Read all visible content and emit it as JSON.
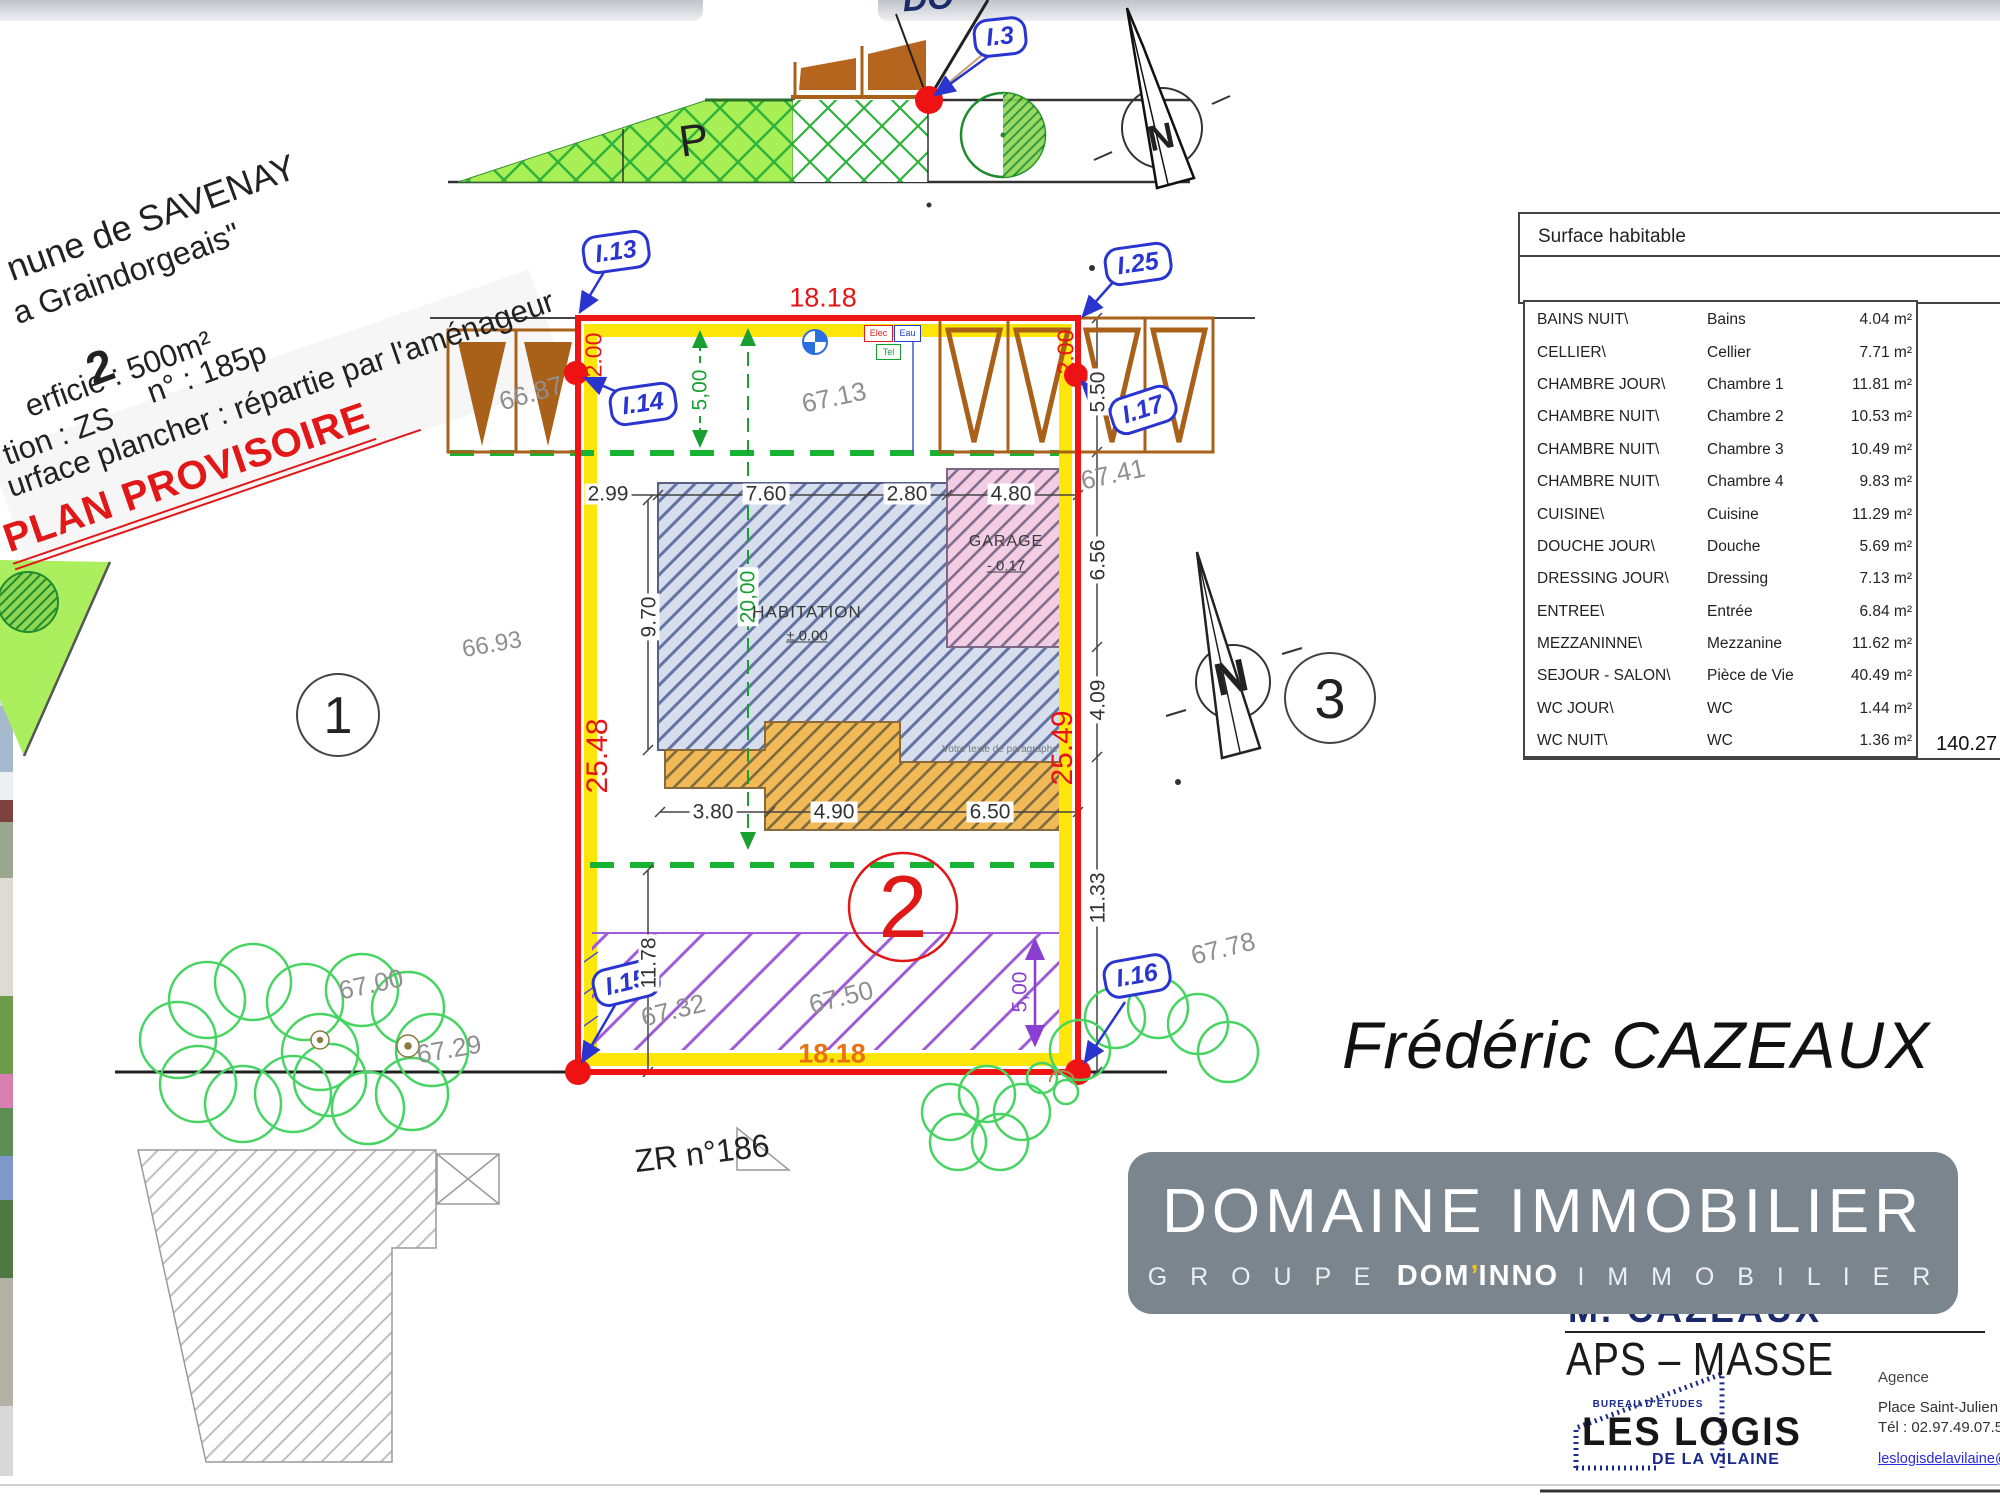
{
  "title_block": {
    "line1": "nune de SAVENAY",
    "line2": "a Graindorgeais\"",
    "lot_number": "2",
    "line3": "erficie : 500m²",
    "line3b": "n° :   185p",
    "line4": "tion : ZS",
    "line5": "urface plancher : répartie par l'aménageur",
    "stamp": "PLAN PROVISOIRE"
  },
  "top_partial_text": "DO",
  "surface_table": {
    "title": "Surface habitable",
    "total": "140.27",
    "rows": [
      {
        "code": "BAINS NUIT\\",
        "name": "Bains",
        "area": "4.04 m²"
      },
      {
        "code": "CELLIER\\",
        "name": "Cellier",
        "area": "7.71 m²"
      },
      {
        "code": "CHAMBRE JOUR\\",
        "name": "Chambre 1",
        "area": "11.81 m²"
      },
      {
        "code": "CHAMBRE NUIT\\",
        "name": "Chambre 2",
        "area": "10.53 m²"
      },
      {
        "code": "CHAMBRE NUIT\\",
        "name": "Chambre 3",
        "area": "10.49 m²"
      },
      {
        "code": "CHAMBRE NUIT\\",
        "name": "Chambre 4",
        "area": "9.83 m²"
      },
      {
        "code": "CUISINE\\",
        "name": "Cuisine",
        "area": "11.29 m²"
      },
      {
        "code": "DOUCHE JOUR\\",
        "name": "Douche",
        "area": "5.69 m²"
      },
      {
        "code": "DRESSING JOUR\\",
        "name": "Dressing",
        "area": "7.13 m²"
      },
      {
        "code": "ENTREE\\",
        "name": "Entrée",
        "area": "6.84 m²"
      },
      {
        "code": "MEZZANINNE\\",
        "name": "Mezzanine",
        "area": "11.62 m²"
      },
      {
        "code": "SEJOUR - SALON\\",
        "name": "Pièce de Vie",
        "area": "40.49 m²"
      },
      {
        "code": "WC JOUR\\",
        "name": "WC",
        "area": "1.44 m²"
      },
      {
        "code": "WC NUIT\\",
        "name": "WC",
        "area": "1.36 m²"
      }
    ]
  },
  "plan": {
    "labels": {
      "i3": "I.3",
      "i13": "I.13",
      "i14": "I.14",
      "i15": "I.15",
      "i16": "I.16",
      "i17": "I.17",
      "i25": "I.25"
    },
    "dims": {
      "top_width": "18.18",
      "bottom_width": "18.18",
      "left_height": "25.48",
      "right_height": "25.49",
      "left_offset": "2.00",
      "right_offset": "2.00",
      "green_front": "5,00",
      "green_depth": "20,00",
      "right_top": "5.50",
      "d299": "2.99",
      "d760": "7.60",
      "d280": "2.80",
      "d480": "4.80",
      "d970": "9.70",
      "d656": "6.56",
      "d409": "4.09",
      "d1133": "11.33",
      "d1178": "11.78",
      "d380": "3.80",
      "d490": "4.90",
      "d650": "6.50",
      "purple_back": "5,00"
    },
    "levels": {
      "l6687": "66.87",
      "l6713": "67.13",
      "l6741": "67.41",
      "l6693": "66.93",
      "l6700": "67.00",
      "l6729": "67.29",
      "l6732": "67.32",
      "l6750": "67.50",
      "l6778": "67.78"
    },
    "rooms": {
      "habitation": "HABITATION",
      "habitation_level": "± 0.00",
      "garage": "GARAGE",
      "garage_level": "- 0.17",
      "note": "Votre texte de paragraphe"
    },
    "markers": {
      "p": "P",
      "north": "N",
      "lot1": "1",
      "lot2": "2",
      "lot3": "3",
      "parcel": "ZR n°186"
    },
    "utilities": {
      "elec": "Elec",
      "eau": "Eau",
      "tel": "Tel"
    },
    "colors": {
      "boundary": "#ee1414",
      "band": "#ffe60a",
      "axis_green": "#18a030",
      "label_blue": "#2a35d0",
      "stamp_red": "#e21818"
    }
  },
  "branding": {
    "agent_name": "Frédéric CAZEAUX",
    "banner_title": "DOMAINE IMMOBILIER",
    "banner_sub_groupe": "G R O U P E",
    "banner_sub_brand_a": "DOM",
    "banner_sub_apostrophe": "’",
    "banner_sub_brand_b": "INNO",
    "banner_sub_immo": "I M M O B I L I E R",
    "partially_hidden_text": "M. CAZEAUX",
    "aps": "APS – MASSE",
    "logis": {
      "bureau": "BUREAU D'ÉTUDES",
      "name": "LES LOGIS",
      "sub": "DE LA VILAINE"
    },
    "agency": {
      "label": "Agence",
      "address": "Place Saint-Julien 56 1",
      "phone": "Tél : 02.97.49.07.51",
      "email": "leslogisdelavilaine@b"
    }
  }
}
